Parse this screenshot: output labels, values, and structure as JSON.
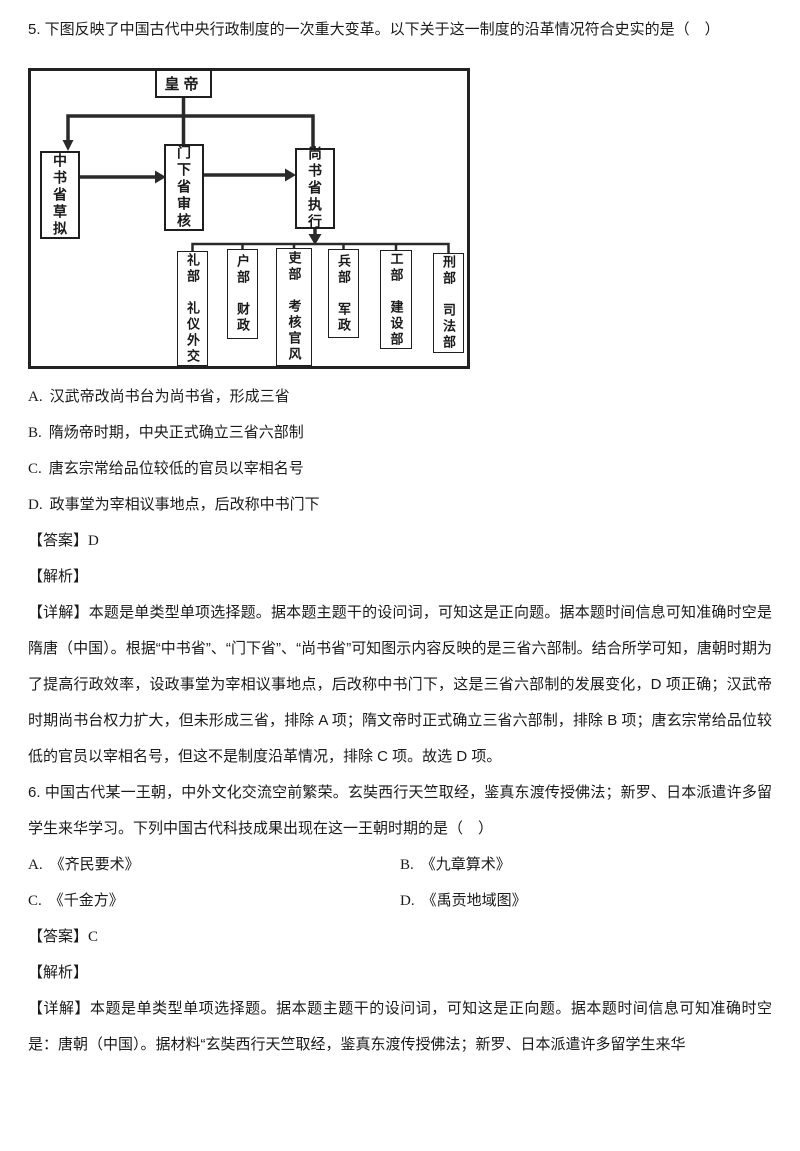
{
  "colors": {
    "ink": "#1a1a1a"
  },
  "q5": {
    "stem": "5. 下图反映了中国古代中央行政制度的一次重大变革。以下关于这一制度的沿革情况符合史实的是（　）",
    "diagram": {
      "emperor": "皇帝",
      "zhongshu": "中书省草拟",
      "menxia": "门下省审核",
      "shangshu": "尚书省执行",
      "ministries": [
        "礼部　礼仪外交",
        "户部　财政",
        "吏部　考核官风",
        "兵部　军政",
        "工部　建设部",
        "刑部　司法部"
      ]
    },
    "options": [
      {
        "label": "A.",
        "text": "汉武帝改尚书台为尚书省，形成三省"
      },
      {
        "label": "B.",
        "text": "隋炀帝时期，中央正式确立三省六部制"
      },
      {
        "label": "C.",
        "text": "唐玄宗常给品位较低的官员以宰相名号"
      },
      {
        "label": "D.",
        "text": "政事堂为宰相议事地点，后改称中书门下"
      }
    ],
    "answer_label": "【答案】",
    "answer": "D",
    "analysis_label": "【解析】",
    "detail": "【详解】本题是单类型单项选择题。据本题主题干的设问词，可知这是正向题。据本题时间信息可知准确时空是隋唐（中国）。根据“中书省”、“门下省”、“尚书省”可知图示内容反映的是三省六部制。结合所学可知，唐朝时期为了提高行政效率，设政事堂为宰相议事地点，后改称中书门下，这是三省六部制的发展变化，D 项正确；汉武帝时期尚书台权力扩大，但未形成三省，排除 A 项；隋文帝时正式确立三省六部制，排除 B 项；唐玄宗常给品位较低的官员以宰相名号，但这不是制度沿革情况，排除 C 项。故选 D 项。"
  },
  "q6": {
    "stem": "6. 中国古代某一王朝，中外文化交流空前繁荣。玄奘西行天竺取经，鉴真东渡传授佛法；新罗、日本派遣许多留学生来华学习。下列中国古代科技成果出现在这一王朝时期的是（　）",
    "options": [
      {
        "label": "A.",
        "text": "《齐民要术》"
      },
      {
        "label": "B.",
        "text": "《九章算术》"
      },
      {
        "label": "C.",
        "text": "《千金方》"
      },
      {
        "label": "D.",
        "text": "《禹贡地域图》"
      }
    ],
    "answer_label": "【答案】",
    "answer": "C",
    "analysis_label": "【解析】",
    "detail": "【详解】本题是单类型单项选择题。据本题主题干的设问词，可知这是正向题。据本题时间信息可知准确时空是：唐朝（中国）。据材料“玄奘西行天竺取经，鉴真东渡传授佛法；新罗、日本派遣许多留学生来华"
  }
}
